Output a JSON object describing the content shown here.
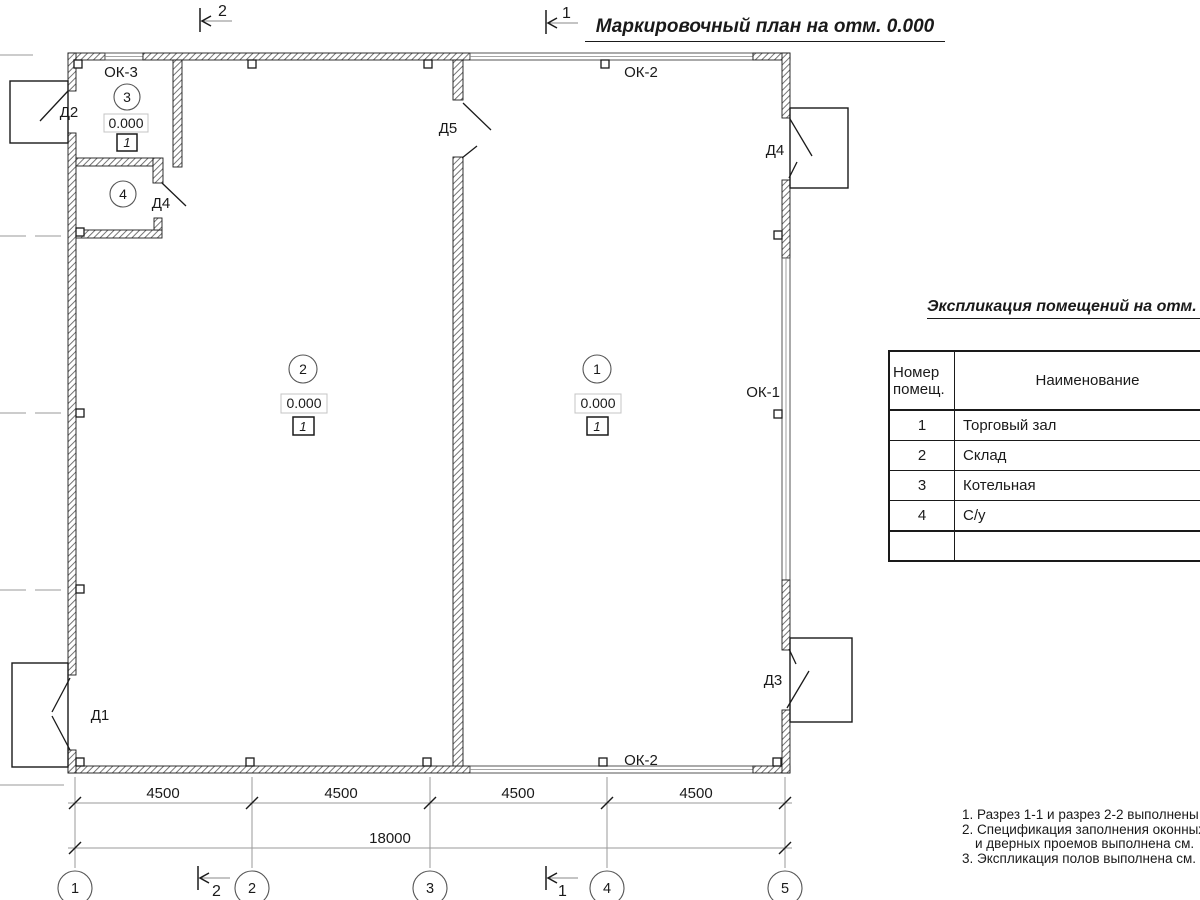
{
  "drawing_title": "Маркировочный план на отм. 0.000",
  "plan": {
    "room1": {
      "num": "1",
      "level": "0.000",
      "floor": "1"
    },
    "room2": {
      "num": "2",
      "level": "0.000",
      "floor": "1"
    },
    "room3": {
      "num": "3",
      "level": "0.000",
      "floor": "1"
    },
    "room4": {
      "num": "4"
    },
    "doors": {
      "d1": "Д1",
      "d2": "Д2",
      "d3": "Д3",
      "d4_right": "Д4",
      "d4_room": "Д4",
      "d5": "Д5"
    },
    "windows": {
      "ok1": "ОК-1",
      "ok2_top": "ОК-2",
      "ok2_bottom": "ОК-2",
      "ok3": "ОК-3"
    }
  },
  "sections": {
    "mark1": "1",
    "mark2": "2"
  },
  "grid_bubbles": {
    "b1": "1",
    "b2": "2",
    "b3": "3",
    "b4": "4",
    "b5": "5"
  },
  "dimensions": {
    "s1": "4500",
    "s2": "4500",
    "s3": "4500",
    "s4": "4500",
    "total": "18000"
  },
  "explication": {
    "title": "Экспликация помещений на отм. 0.000",
    "col_number": "Номер помещ.",
    "col_name": "Наименование",
    "rows": [
      {
        "num": "1",
        "name": "Торговый зал"
      },
      {
        "num": "2",
        "name": "Склад"
      },
      {
        "num": "3",
        "name": "Котельная"
      },
      {
        "num": "4",
        "name": "С/у"
      }
    ]
  },
  "notes": {
    "line1": "1. Разрез 1-1 и разрез 2-2 выполнены",
    "line2": "2. Спецификация заполнения оконных",
    "line2b": "и дверных проемов выполнена см.",
    "line3": "3. Экспликация полов выполнена см."
  }
}
